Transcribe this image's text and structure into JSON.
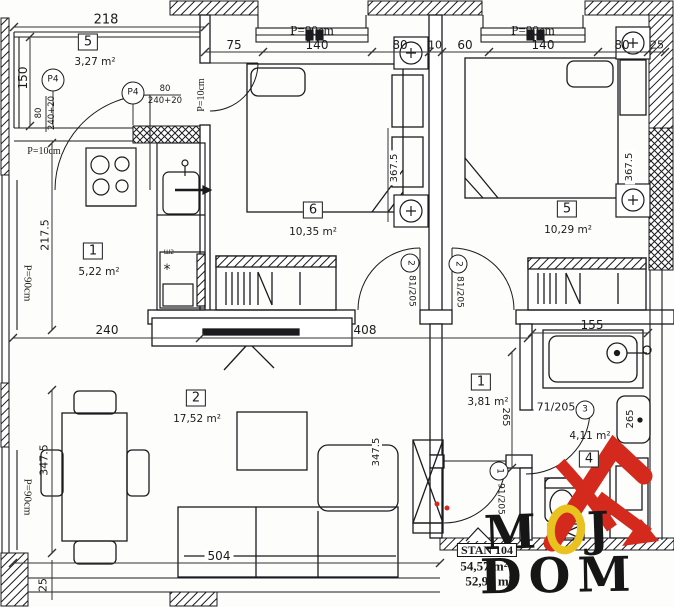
{
  "drawing": {
    "rooms": [
      {
        "number": "5",
        "area": "3,27 m²"
      },
      {
        "number": "1",
        "area": "5,22 m²"
      },
      {
        "number": "6",
        "area": "10,35 m²"
      },
      {
        "number": "5",
        "area": "10,29 m²"
      },
      {
        "number": "2",
        "area": "17,52 m²"
      },
      {
        "number": "1",
        "area": "3,81 m²"
      },
      {
        "number": "4",
        "area": "4,11 m²"
      }
    ]
  },
  "labels": {
    "d218": "218",
    "d150": "150",
    "d2175": "217.5",
    "d3475a": "347.5",
    "d3475b": "347.5",
    "d25a": "25",
    "d25b": "25",
    "d75": "75",
    "d140a": "140",
    "d80a": "80",
    "d10": "10",
    "d60": "60",
    "d140b": "140",
    "d80b": "80",
    "d3675a": "367.5",
    "d3675b": "367.5",
    "d240": "240",
    "d408": "408",
    "d155": "155",
    "d504": "504",
    "d265a": "265",
    "d265b": "265",
    "p90a": "P=90cm",
    "p90b": "P=90cm",
    "p90c": "P=90cm",
    "p90d": "P=90cm",
    "p10a": "P=10cm",
    "p10b": "P=10cm",
    "sh2": "Ш2",
    "star": "*"
  },
  "window_tags": [
    {
      "no": "P4",
      "w": "80",
      "h": "240+20"
    },
    {
      "no": "P4",
      "w": "80",
      "h": "240+20"
    }
  ],
  "door_tags": [
    {
      "no": "2",
      "size": "81/205"
    },
    {
      "no": "2",
      "size": "81/205"
    },
    {
      "no": "3",
      "size": "71/205"
    },
    {
      "no": "1",
      "size": "91/205"
    }
  ],
  "title_block": {
    "apartment": "STAN 104",
    "area_gross": "54,57 m²",
    "area_net": "52,93 m²"
  },
  "logo": {
    "m": "M",
    "o": "O",
    "j": "J",
    "dom": "DOM"
  },
  "colors": {
    "line": "#1b1b1e",
    "logo_red": "#d42a1d",
    "logo_yellow": "#eac21f"
  }
}
